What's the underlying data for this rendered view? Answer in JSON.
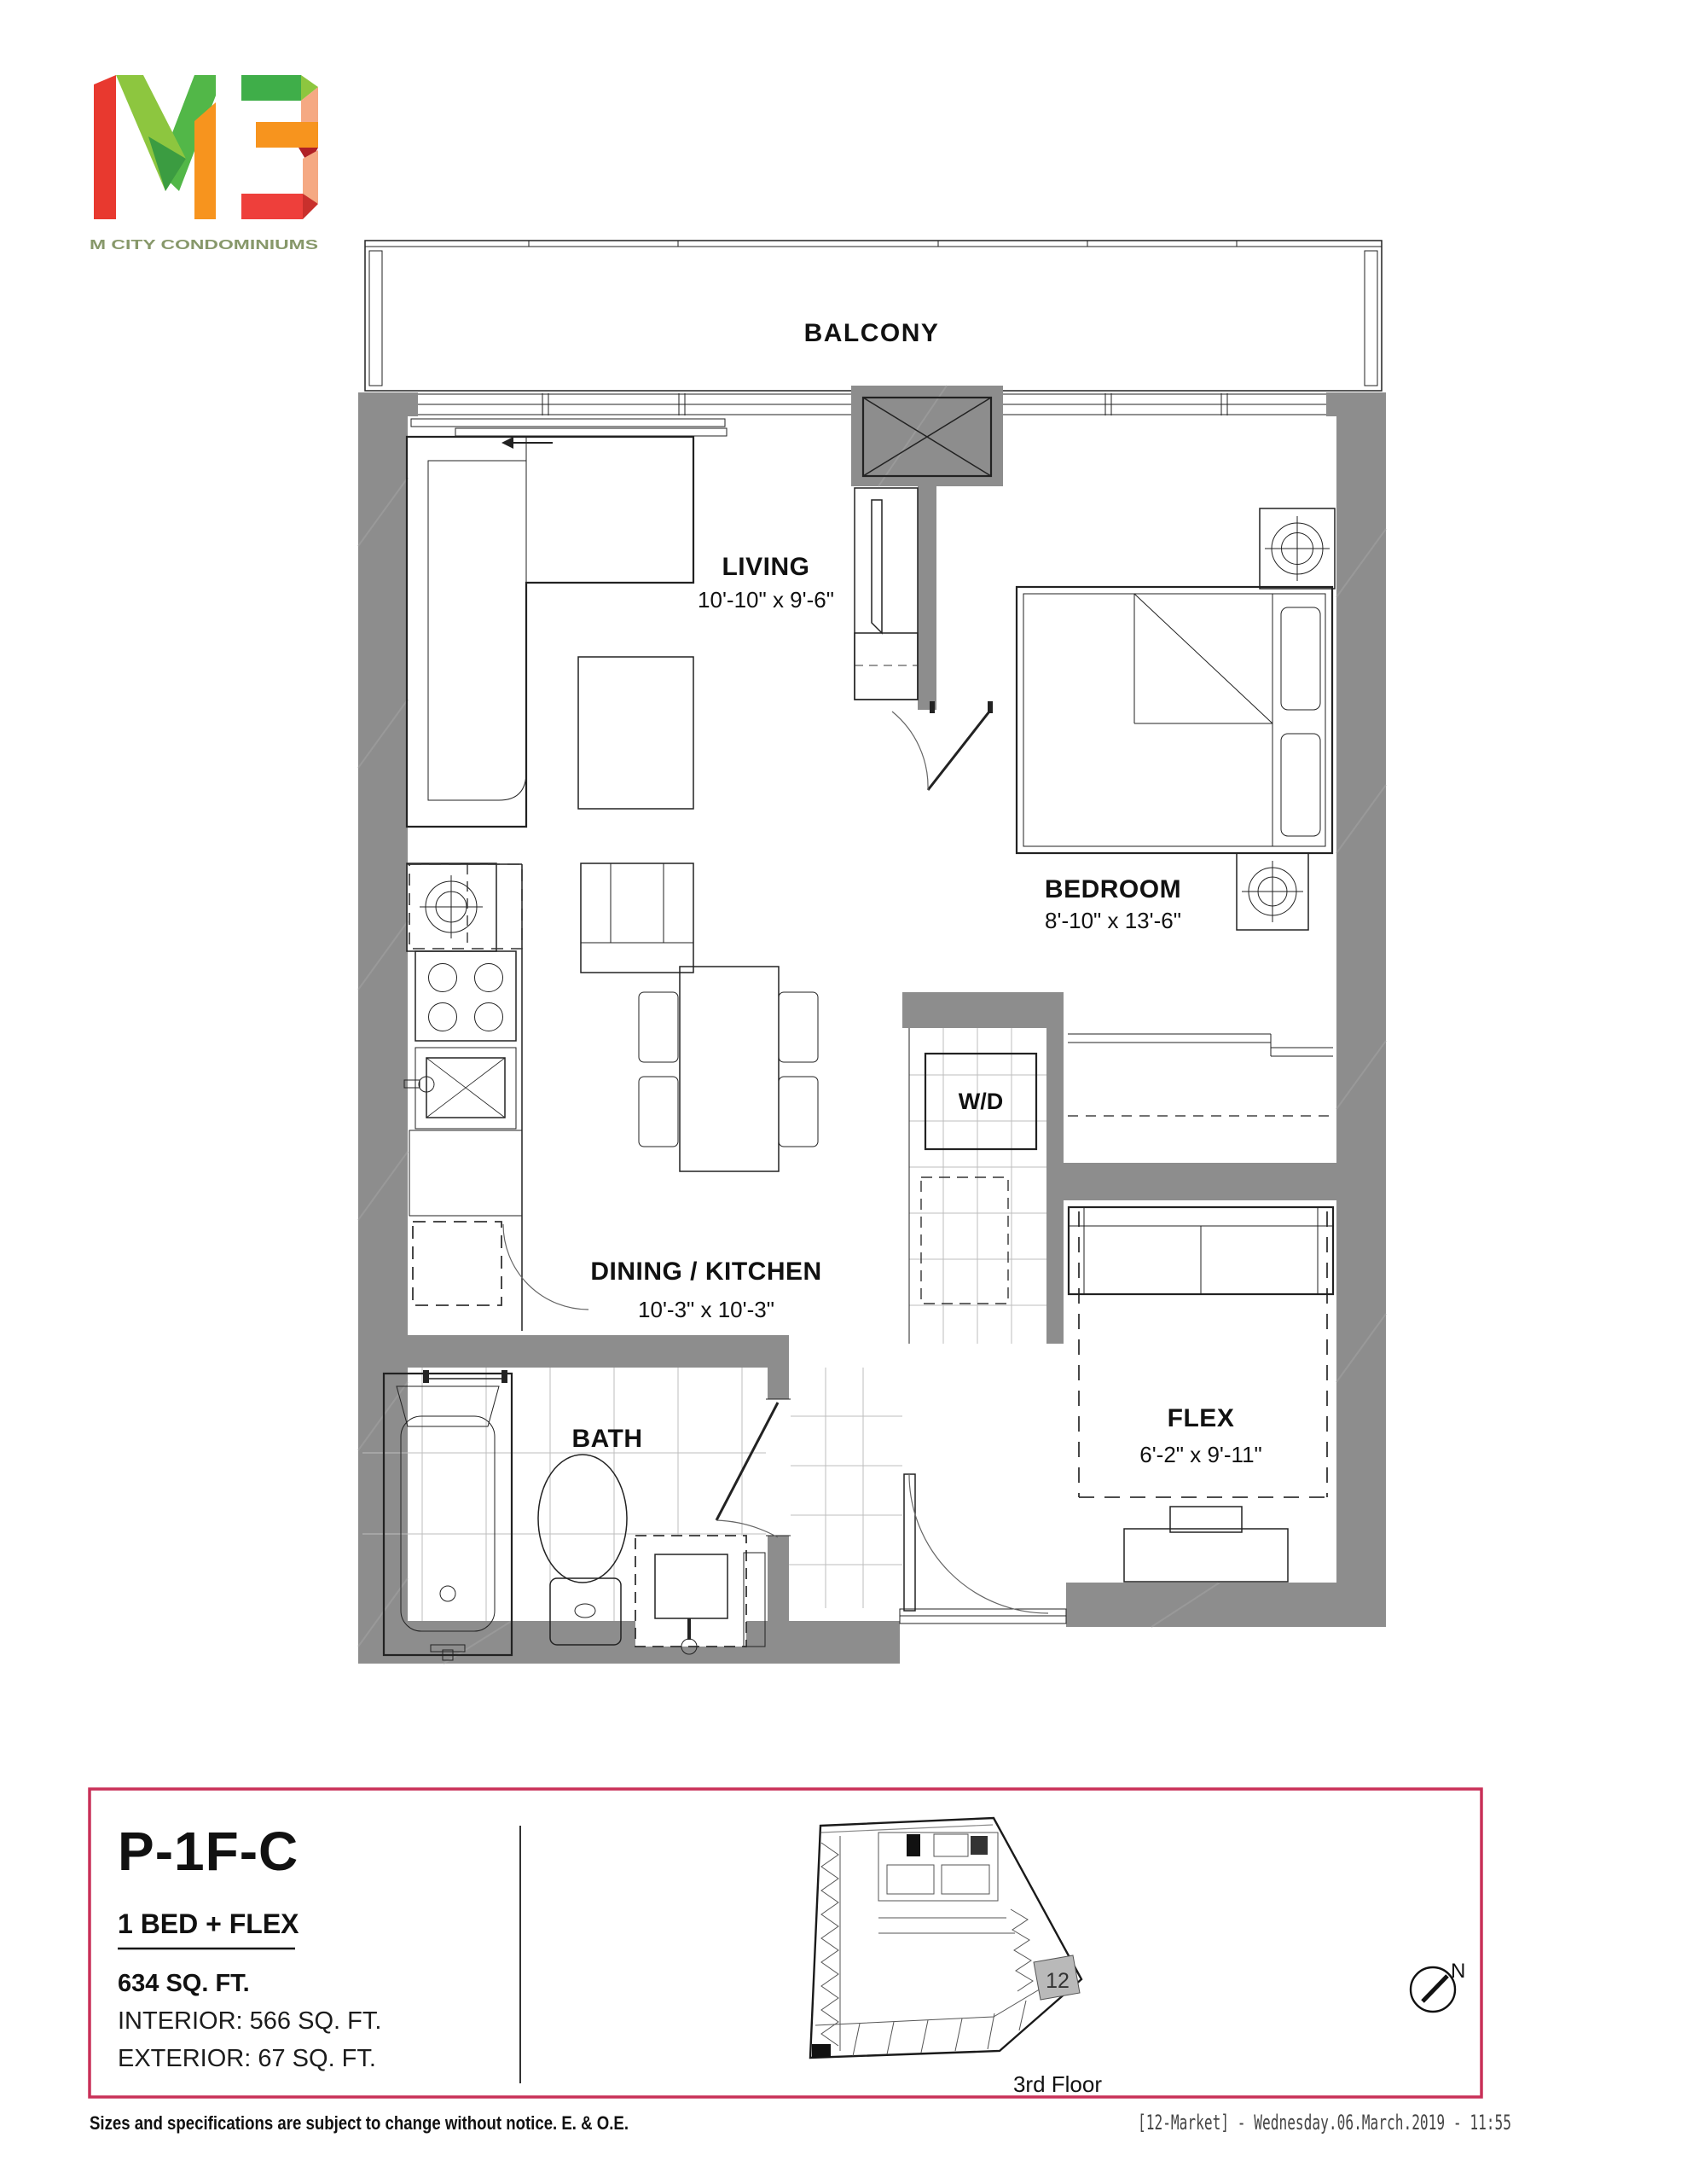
{
  "logo": {
    "brand": "M3",
    "tagline": "M CITY CONDOMINIUMS"
  },
  "plan": {
    "balcony": {
      "label": "BALCONY"
    },
    "living": {
      "name": "LIVING",
      "dims": "10'-10\" x 9'-6\""
    },
    "bedroom": {
      "name": "BEDROOM",
      "dims": "8'-10\" x 13'-6\""
    },
    "dining_kitchen": {
      "name": "DINING / KITCHEN",
      "dims": "10'-3\" x 10'-3\""
    },
    "bath": {
      "name": "BATH"
    },
    "flex": {
      "name": "FLEX",
      "dims": "6'-2\" x 9'-11\""
    },
    "laundry": {
      "label": "W/D"
    }
  },
  "unit_panel": {
    "code": "P-1F-C",
    "type": "1 BED + FLEX",
    "total_area": "634 SQ. FT.",
    "interior_area": "INTERIOR:  566 SQ. FT.",
    "exterior_area": "EXTERIOR:  67 SQ. FT."
  },
  "keyplan": {
    "unit_number": "12",
    "floor_label": "3rd Floor"
  },
  "compass": {
    "label": "N"
  },
  "footer": {
    "disclaimer": "Sizes and specifications are subject to change without notice. E. & O.E.",
    "plot_stamp": "[12-Market]  -  Wednesday.06.March.2019  -  11:55"
  },
  "colors": {
    "accent": "#c93058",
    "wall": "#8d8d8d",
    "logo_red": "#e8392f",
    "logo_green": "#52b748",
    "logo_light_green": "#8dc63f",
    "logo_orange": "#f7941e",
    "logo_tagline_green": "#87986a"
  }
}
